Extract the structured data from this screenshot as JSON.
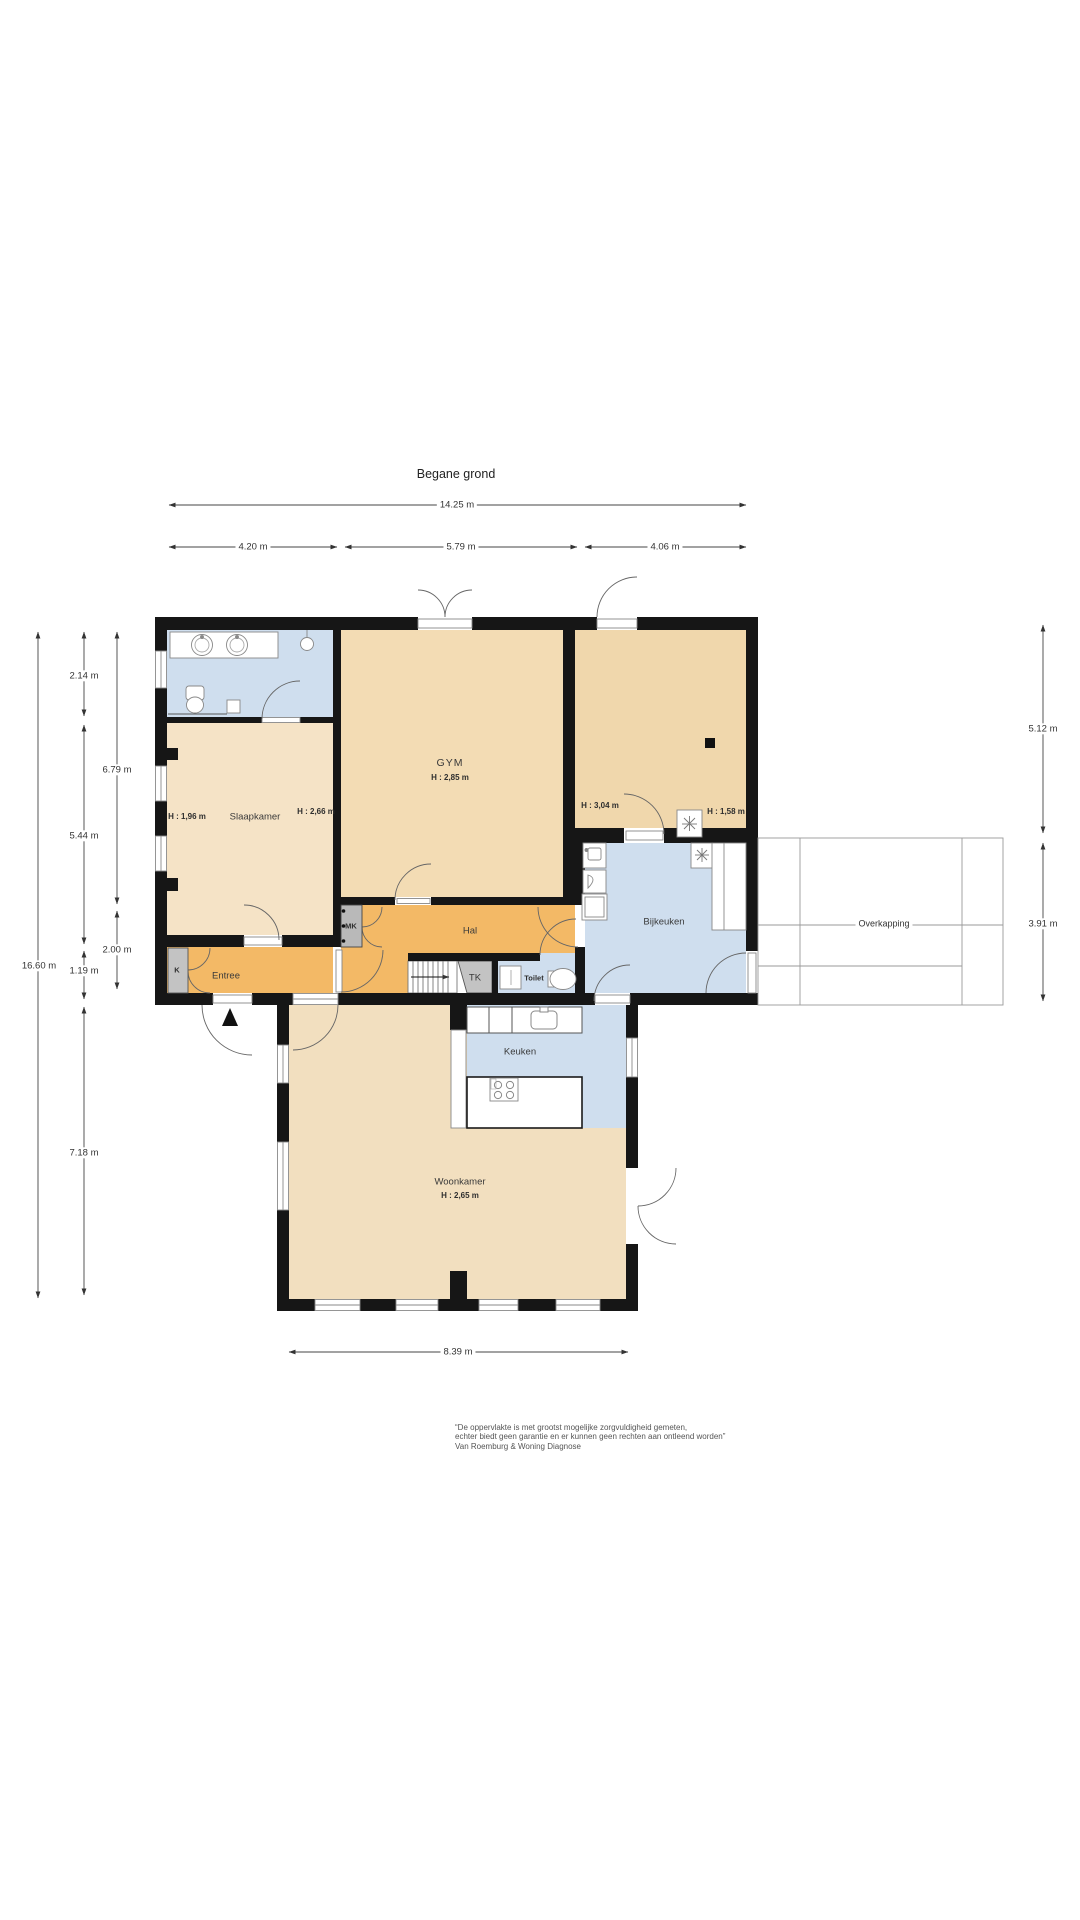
{
  "title": "Begane grond",
  "dims": {
    "total_width": "14.25 m",
    "seg_a": "4.20 m",
    "seg_b": "5.79 m",
    "seg_c": "4.06 m",
    "total_height": "16.60 m",
    "bath_h": "2.14 m",
    "slaap_h": "5.44 m",
    "entree_h": "1.19 m",
    "woon_h": "7.18 m",
    "col2_a": "6.79 m",
    "col2_b": "2.00 m",
    "right_a": "5.12 m",
    "right_b": "3.91 m",
    "woon_w": "8.39 m"
  },
  "rooms": {
    "gym": {
      "label": "GYM",
      "height": "H : 2,85 m"
    },
    "slaapkamer": {
      "label": "Slaapkamer",
      "h_left": "H : 1,96 m",
      "h_right": "H : 2,66 m"
    },
    "right_room": {
      "h_left": "H : 3,04 m",
      "h_right": "H : 1,58 m"
    },
    "bijkeuken": {
      "label": "Bijkeuken"
    },
    "hal": {
      "label": "Hal"
    },
    "entree": {
      "label": "Entree"
    },
    "toilet": {
      "label": "Toilet"
    },
    "keuken": {
      "label": "Keuken"
    },
    "woonkamer": {
      "label": "Woonkamer",
      "height": "H : 2,65 m"
    },
    "mk": {
      "label": "MK"
    },
    "tk": {
      "label": "TK"
    },
    "k": {
      "label": "K"
    },
    "overkapping": {
      "label": "Overkapping"
    }
  },
  "footer": {
    "line1": "“De oppervlakte is met grootst mogelijke zorgvuldigheid gemeten,",
    "line2": "echter biedt geen garantie en er kunnen geen rechten aan ontleend worden”",
    "line3": "Van Roemburg & Woning Diagnose"
  },
  "colors": {
    "wall": "#161616",
    "wet_room_blue": "#cfdeee",
    "hall_orange": "#f3b966",
    "bedroom_beige": "#f5e3c6",
    "gym_beige": "#f3dcb4",
    "living_beige": "#f2dfbf",
    "closet_gray": "#c3c3c3"
  }
}
